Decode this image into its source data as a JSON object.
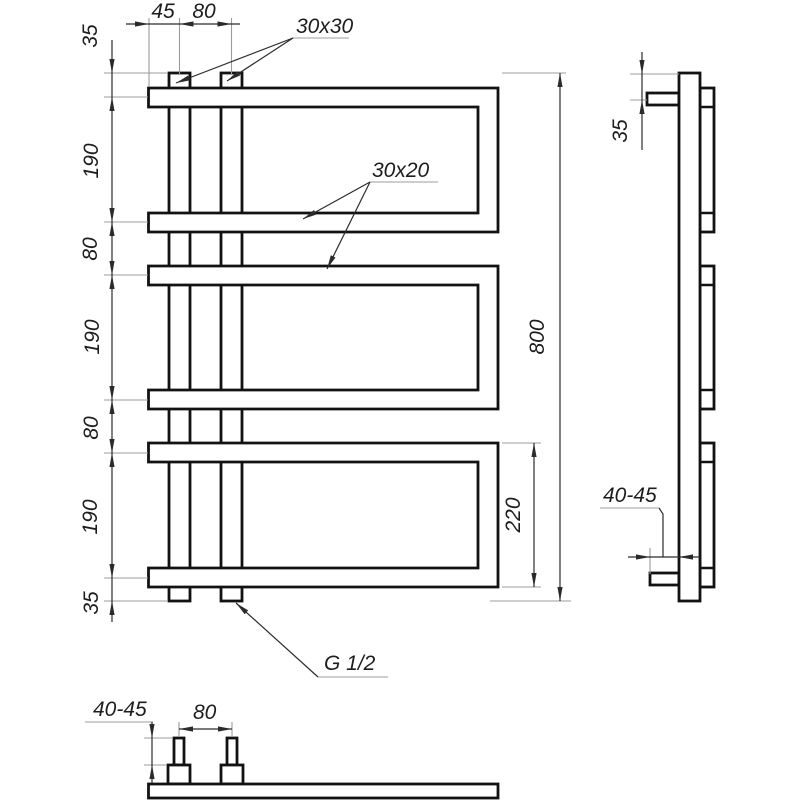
{
  "front_view": {
    "dim_left_offset": "45",
    "dim_riser_spacing": "80",
    "label_riser_profile": "30x30",
    "dims_vertical": [
      "35",
      "190",
      "80",
      "190",
      "80",
      "190",
      "35"
    ],
    "label_rung_profile": "30x20",
    "dim_total_height": "800",
    "dim_loop_height": "220",
    "label_connection_thread": "G 1/2"
  },
  "side_view": {
    "dim_top_offset": "35",
    "dim_wall_standoff": "40-45"
  },
  "bottom_view": {
    "dim_wall_standoff": "40-45",
    "dim_pipe_spacing": "80"
  }
}
